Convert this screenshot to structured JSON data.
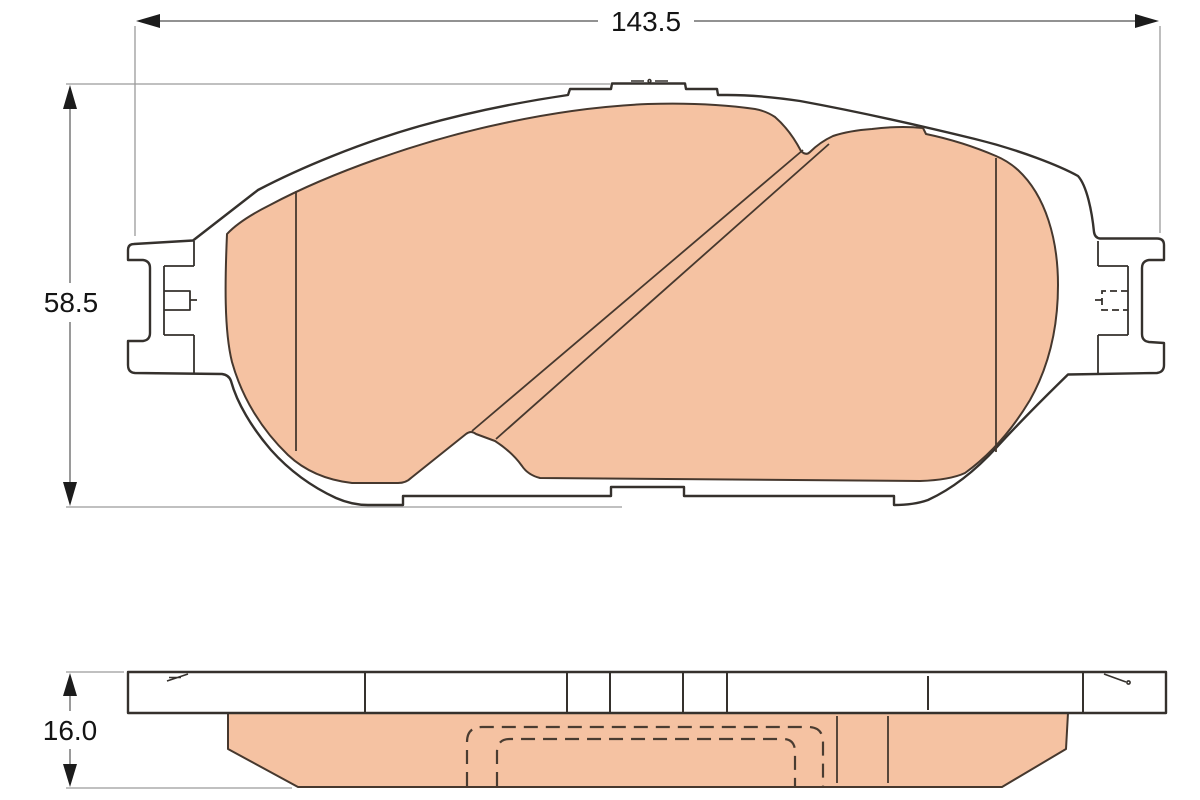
{
  "drawing": {
    "dimension_labels": {
      "width": "143.5",
      "height": "58.5",
      "thickness": "16.0"
    },
    "colors": {
      "friction": "#f5c2a2",
      "plate": "#ffffff",
      "outline": "#35312d",
      "dimension": "#6e6e6e",
      "extension": "#9a9a9a",
      "text": "#141414"
    }
  }
}
